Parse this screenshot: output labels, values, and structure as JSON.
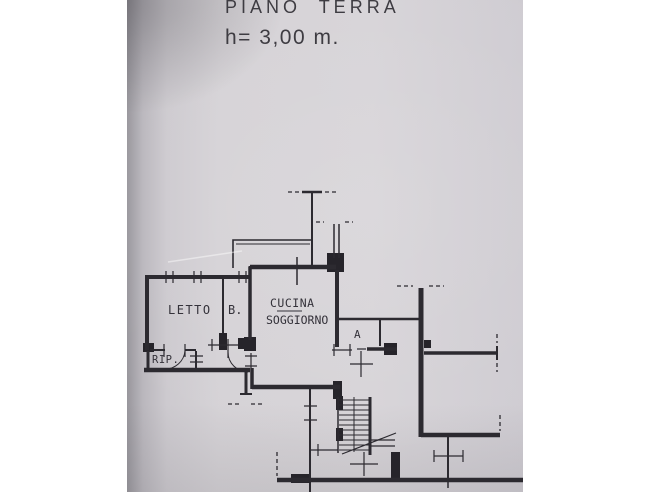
{
  "titles": {
    "plan_title": "PIANO TERRA",
    "height_note": "h= 3,00 m."
  },
  "colors": {
    "page_margin": "#ffffff",
    "paper": "#d6d3d7",
    "ink": "#2c2a30"
  },
  "plan": {
    "rooms": [
      {
        "key": "letto",
        "label": "LETTO"
      },
      {
        "key": "bagno",
        "label": "B."
      },
      {
        "key": "cucina",
        "label": "CUCINA"
      },
      {
        "key": "soggiorno",
        "label": "SOGGIORNO"
      },
      {
        "key": "ingresso-a",
        "label": "A"
      },
      {
        "key": "ripostiglio",
        "label": "RIP."
      }
    ]
  }
}
